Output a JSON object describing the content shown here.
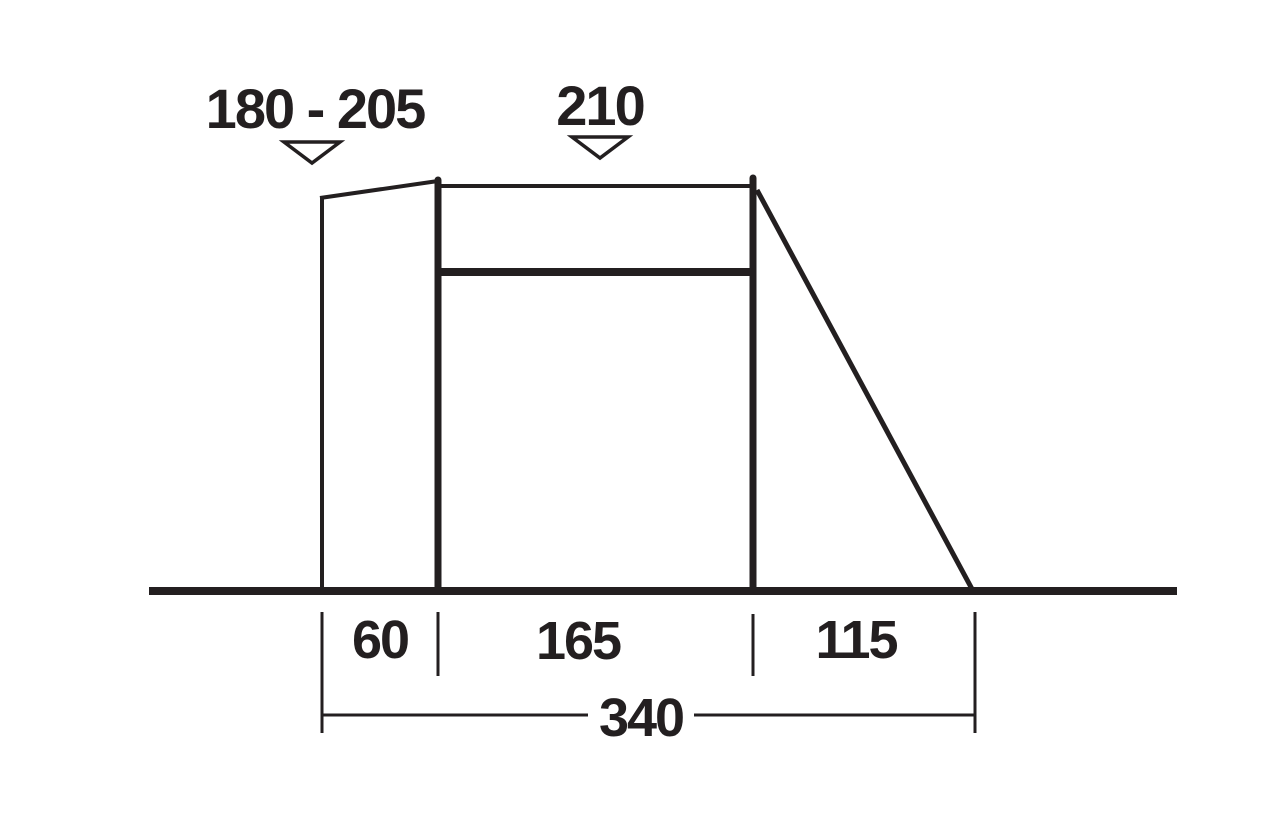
{
  "page": {
    "background": "#ffffff",
    "line_color": "#231f20",
    "description": "Side-profile dimension diagram of a tent awning"
  },
  "icons": {
    "height_marker": "triangle-down-icon"
  },
  "dimensions": {
    "heights": [
      {
        "label": "180 - 205"
      },
      {
        "label": "210"
      }
    ],
    "widths": [
      {
        "label": "60"
      },
      {
        "label": "165"
      },
      {
        "label": "115"
      }
    ],
    "total_width": {
      "label": "340"
    }
  }
}
